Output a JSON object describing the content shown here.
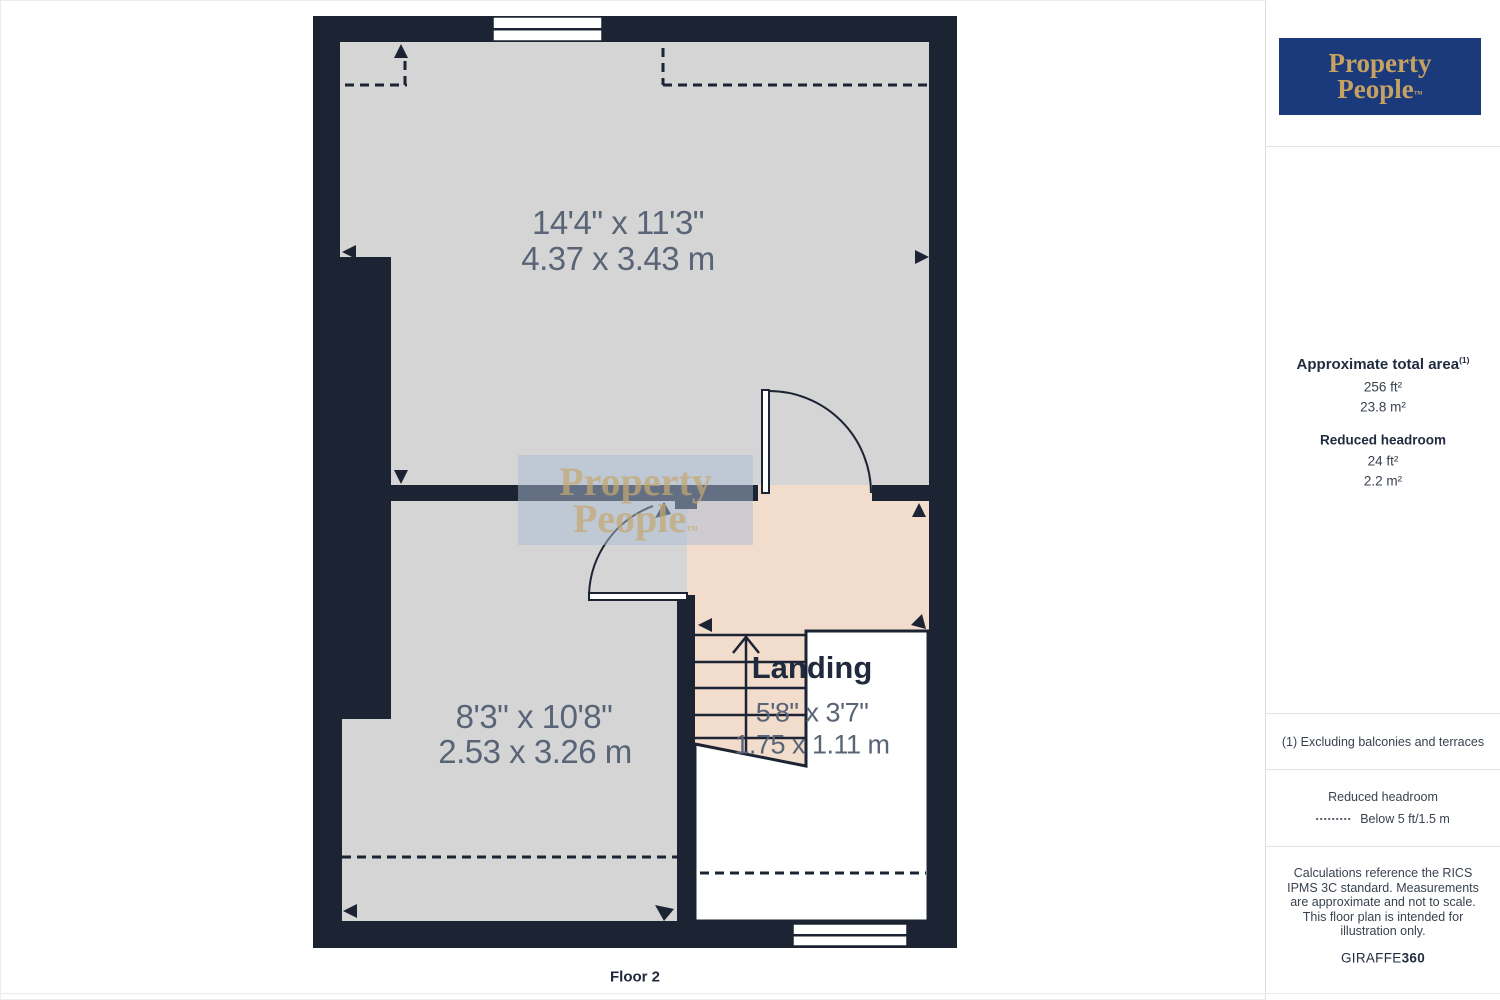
{
  "colors": {
    "wall": "#1c2433",
    "room_fill": "#d5d5d6",
    "landing_fill": "#f2dccc",
    "dimension_text": "#5a6477",
    "label_text": "#202a3c",
    "logo_background": "#1a3a7c",
    "logo_gold": "#c6a262",
    "watermark_overlay": "#a9bcd4"
  },
  "plan": {
    "floor_label": "Floor 2",
    "room1": {
      "dims_imperial": "14'4\" x 11'3\"",
      "dims_metric": "4.37 x 3.43 m"
    },
    "room2": {
      "dims_imperial": "8'3\" x 10'8\"",
      "dims_metric": "2.53 x 3.26 m"
    },
    "landing": {
      "label": "Landing",
      "dims_imperial": "5'8\" x 3'7\"",
      "dims_metric": "1.75 x 1.11 m"
    },
    "watermark": {
      "line1": "Property",
      "line2": "People",
      "tm": "™"
    }
  },
  "sidebar": {
    "logo": {
      "line1": "Property",
      "line2": "People",
      "tm": "™"
    },
    "total_area": {
      "heading": "Approximate total area",
      "footnote_ref": "(1)",
      "imperial": "256 ft²",
      "metric": "23.8 m²"
    },
    "reduced_headroom": {
      "heading": "Reduced headroom",
      "imperial": "24 ft²",
      "metric": "2.2 m²"
    },
    "footnote": "(1) Excluding balconies and terraces",
    "legend": {
      "heading": "Reduced headroom",
      "label": "Below 5 ft/1.5 m"
    },
    "disclaimer": "Calculations reference the RICS IPMS 3C standard. Measurements are approximate and not to scale. This floor plan is intended for illustration only.",
    "brand": {
      "name": "GIRAFFE",
      "suffix": "360"
    }
  }
}
